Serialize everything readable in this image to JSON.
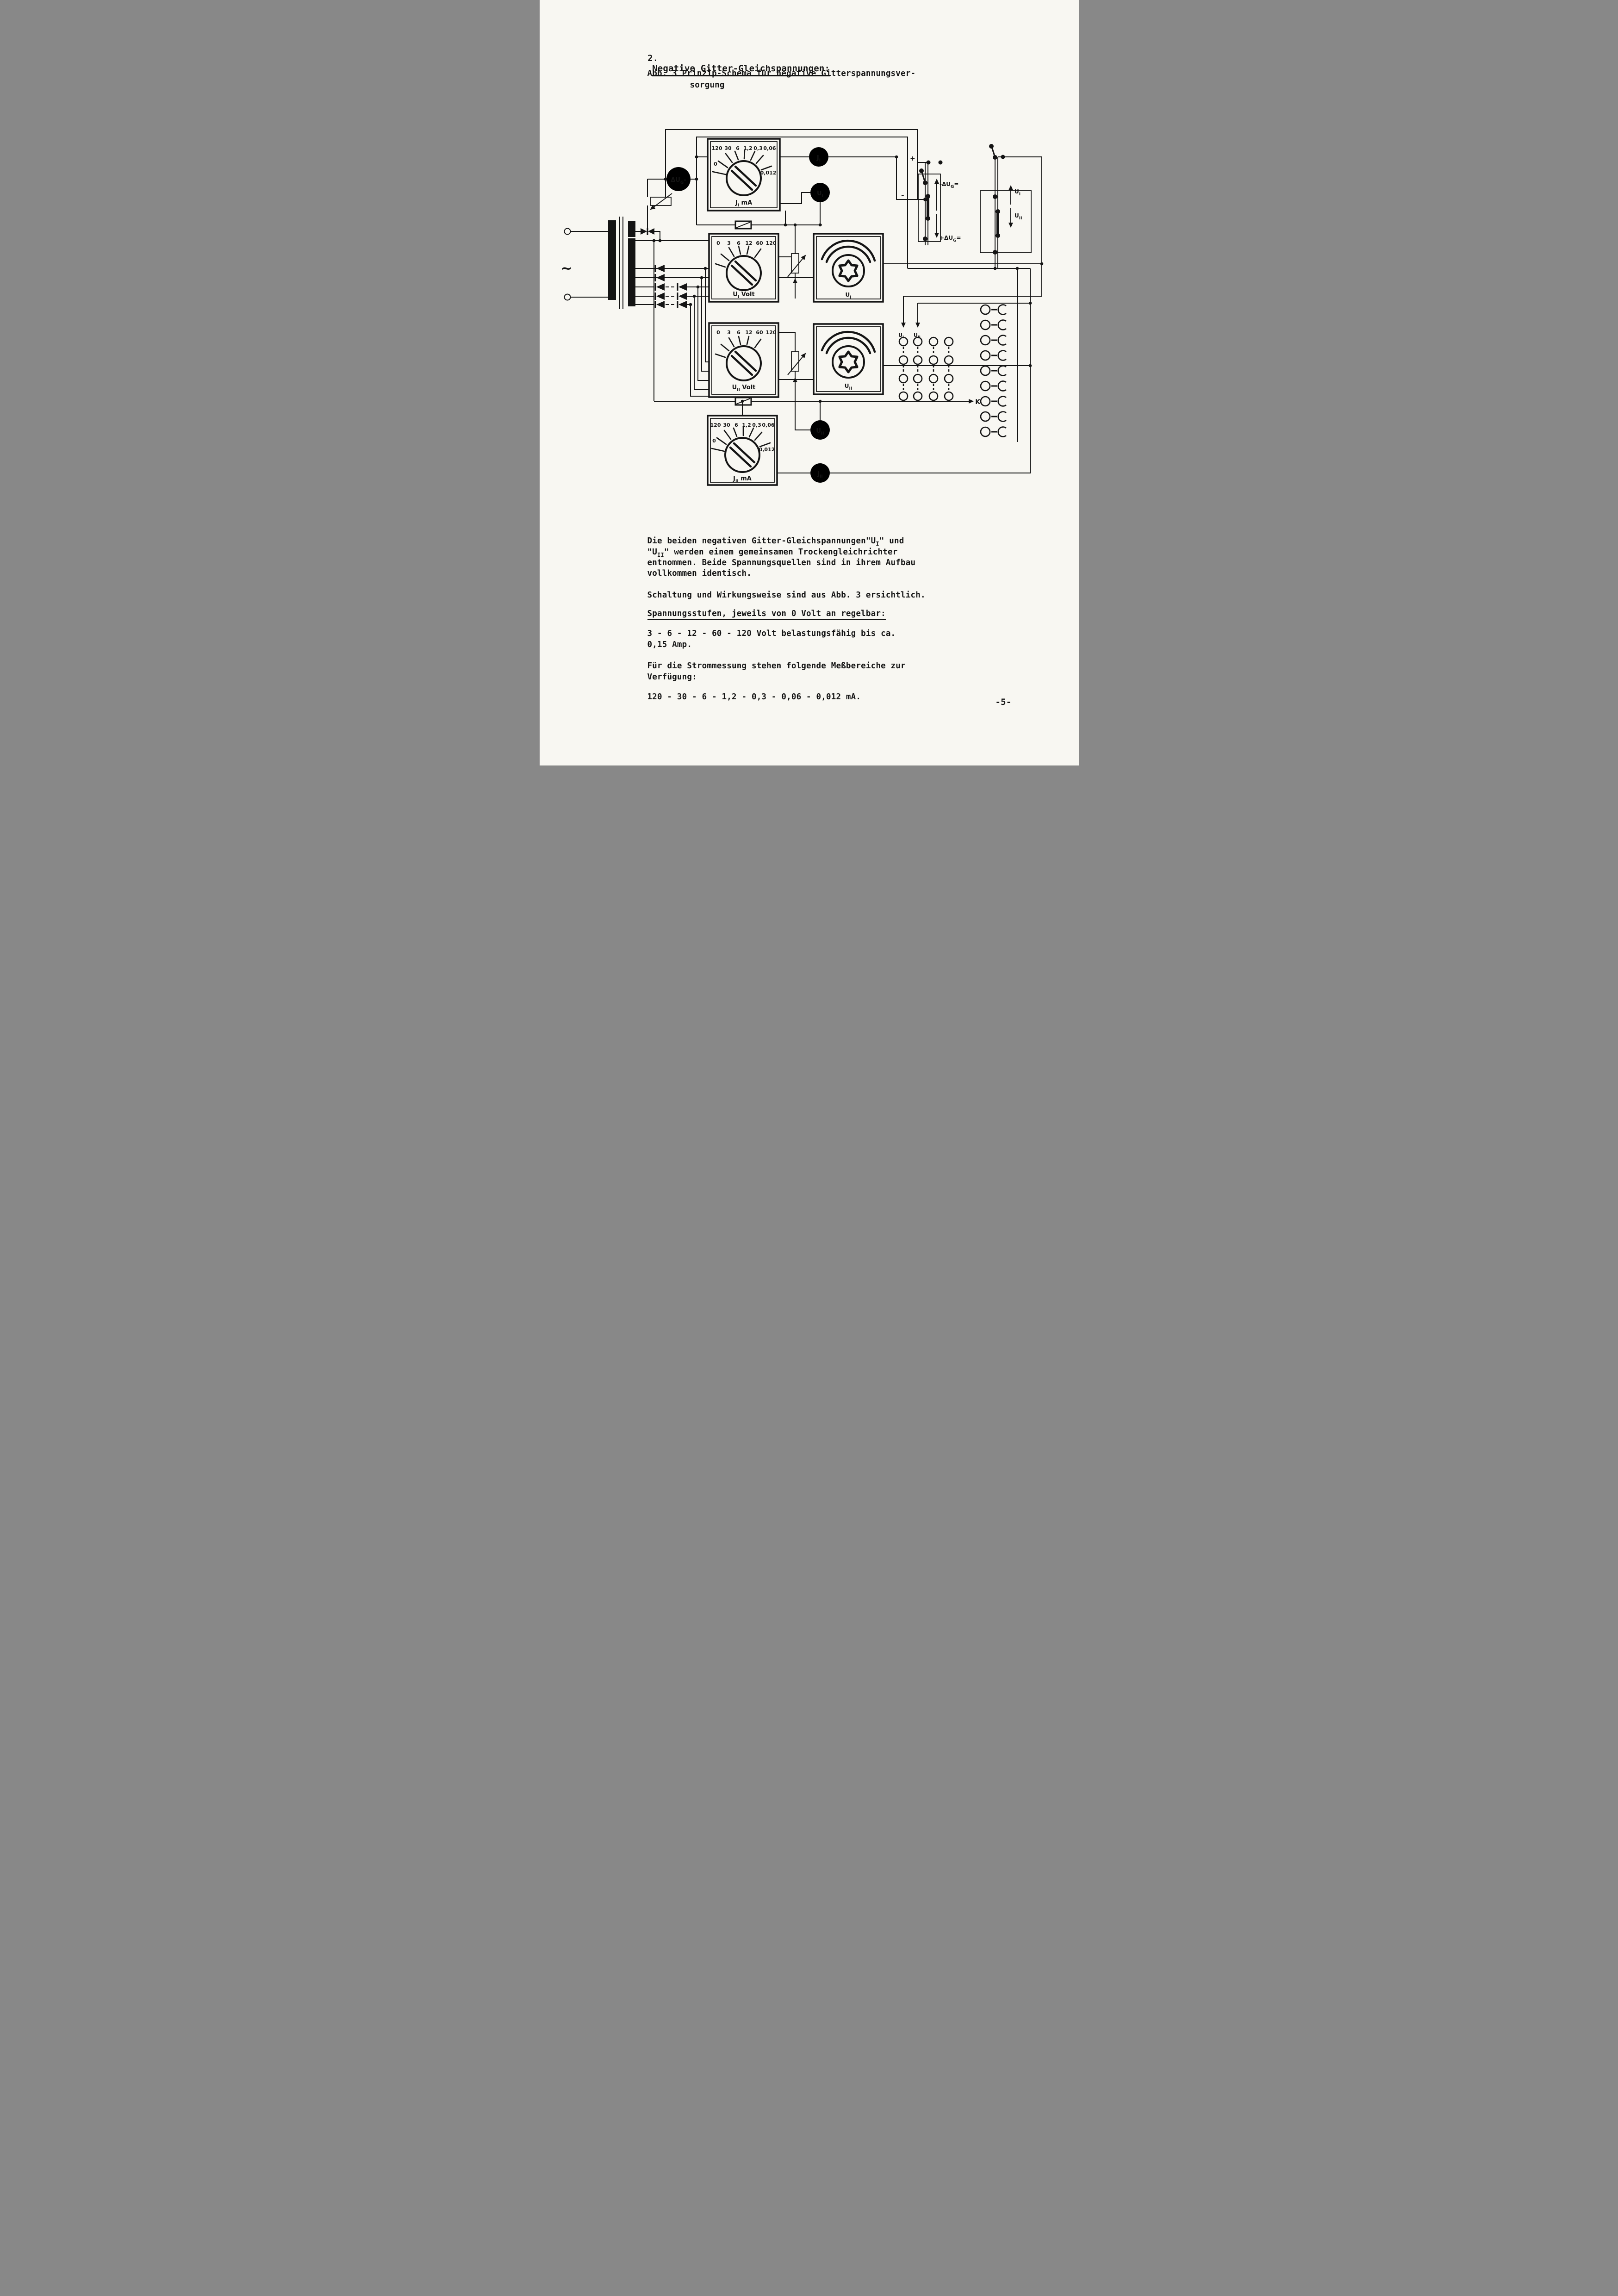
{
  "page": {
    "number": "-5-"
  },
  "title": {
    "num": "2.",
    "text": "Negative Gitter-Gleichspannungen:"
  },
  "caption": {
    "line1": "Abb. 3 Prinzip-Schema für negative Gitterspannungsver-",
    "line2": "sorgung"
  },
  "body": {
    "l1_pre": "Die beiden negativen Gitter-Gleichspannungen\"U",
    "l1_sub": "I",
    "l1_post": "\" und",
    "l2_pre": "\"U",
    "l2_sub": "II",
    "l2_post": "\" werden einem gemeinsamen Trockengleichrichter",
    "l3": "entnommen. Beide Spannungsquellen sind in ihrem Aufbau",
    "l4": "vollkommen identisch.",
    "l5": "Schaltung und Wirkungsweise sind aus Abb. 3 ersichtlich.",
    "l6": "Spannungsstufen, jeweils von 0 Volt an regelbar:",
    "l7": "3 - 6 - 12 - 60 - 120 Volt belastungsfähig bis ca.",
    "l8": "0,15 Amp.",
    "l9": "Für die Strommessung stehen folgende Meßbereiche zur",
    "l10": "Verfügung:",
    "l11": "120 - 30 - 6 - 1,2 - 0,3 - 0,06 - 0,012 mA."
  },
  "diagram": {
    "ac": "~",
    "plus": "+",
    "minus": "-",
    "k": "K",
    "switch_ji": {
      "s1": "120",
      "s2": "30",
      "s3": "6",
      "s4": "1,2",
      "s5": "0,3",
      "s6": "0,06",
      "left": "0",
      "right": "0,012",
      "base": "J",
      "sub": "I",
      "unit": " mA"
    },
    "switch_jii": {
      "s1": "120",
      "s2": "30",
      "s3": "6",
      "s4": "1,2",
      "s5": "0,3",
      "s6": "0,06",
      "left": "0",
      "right": "0,012",
      "base": "J",
      "sub": "II",
      "unit": " mA"
    },
    "switch_ui": {
      "s1": "0",
      "s2": "3",
      "s3": "6",
      "s4": "12",
      "s5": "60",
      "s6": "120",
      "base": "U",
      "sub": "I",
      "unit": " Volt"
    },
    "switch_uii": {
      "s1": "0",
      "s2": "3",
      "s3": "6",
      "s4": "12",
      "s5": "60",
      "s6": "120",
      "base": "U",
      "sub": "II",
      "unit": " Volt"
    },
    "meter_dug": {
      "base": "ΔU",
      "sub": "G",
      "suffix": "-"
    },
    "meter_ji": {
      "base": "J",
      "sub": "I"
    },
    "meter_ui": {
      "base": "U",
      "sub": "I"
    },
    "meter_uii": {
      "base": "U",
      "sub": "II"
    },
    "meter_jii": {
      "base": "J",
      "sub": "II"
    },
    "variac_ui": {
      "base": "U",
      "sub": "I"
    },
    "variac_uii": {
      "base": "U",
      "sub": "II"
    },
    "patch": {
      "neg": {
        "pre": "-ΔU",
        "sub": "G",
        "post": "="
      },
      "pos": {
        "pre": "+ΔU",
        "sub": "G",
        "post": "="
      },
      "u1": {
        "base": "U",
        "sub": "I"
      },
      "u2": {
        "base": "U",
        "sub": "II"
      }
    },
    "grid": {
      "c1": {
        "base": "U",
        "sub": "I"
      },
      "c2": {
        "base": "U",
        "sub": "II"
      }
    }
  }
}
